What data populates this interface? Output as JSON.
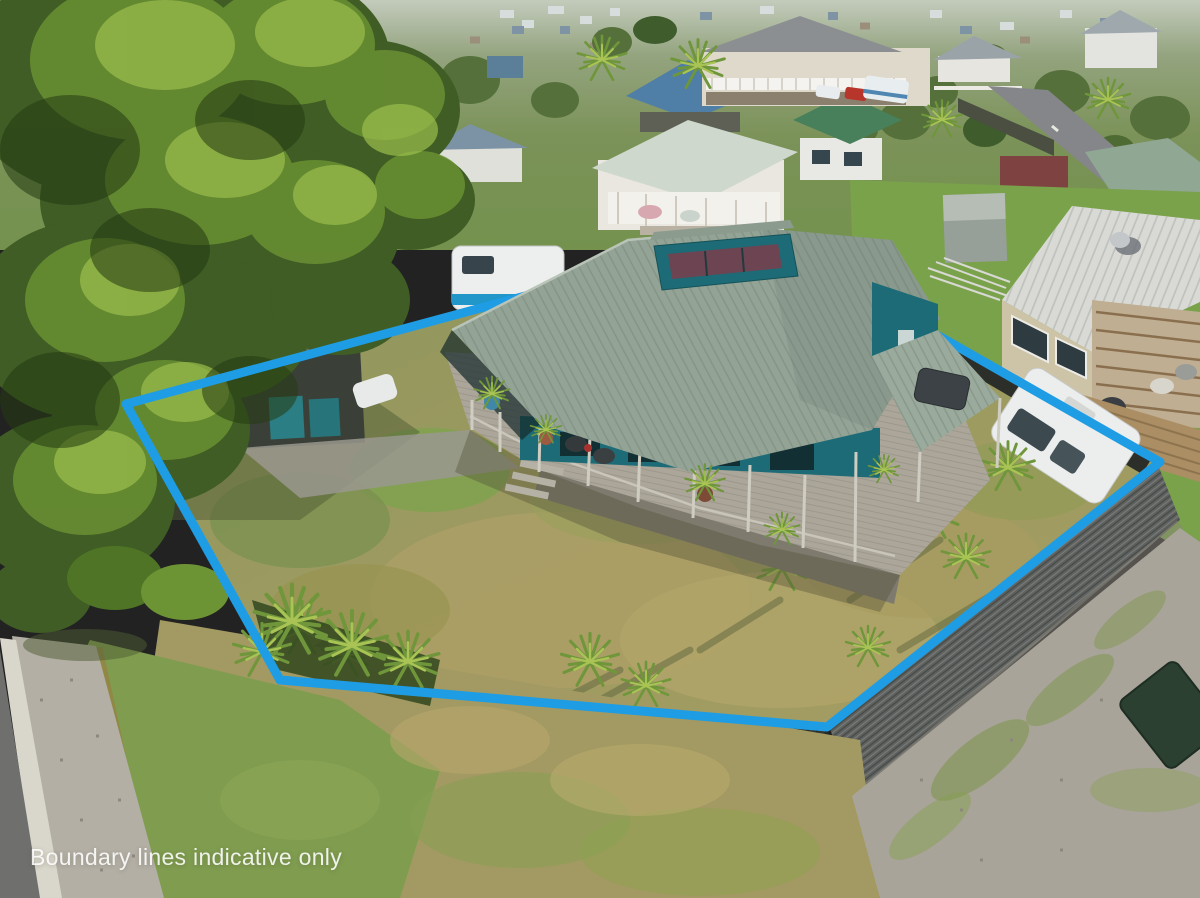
{
  "photo": {
    "kind": "aerial-drone-photograph",
    "subject": "residential property with marketed boundary overlay",
    "width": 1200,
    "height": 898
  },
  "watermark": {
    "text": "Boundary lines indicative only",
    "color": "#ffffff"
  },
  "boundary": {
    "color": "#1e9de4",
    "stroke_width": 9,
    "points": "758,233 1160,462 827,727 280,680 126,404"
  },
  "palette": {
    "subject_roof": "#93a396",
    "subject_walls": "#1d6b76",
    "deck_timber": "#aba699",
    "fence_dark": "#3b3d3a",
    "fence_corrugated": "#5f6260",
    "lawn_dry": "#9c9a60",
    "lawn_green": "#7aa24b",
    "conifer_tree": "#3f5d24",
    "caravan": "#eceeed",
    "gravel": "#a9a49a",
    "road_asphalt": "#85868a",
    "kerb": "#d9d6cb"
  }
}
